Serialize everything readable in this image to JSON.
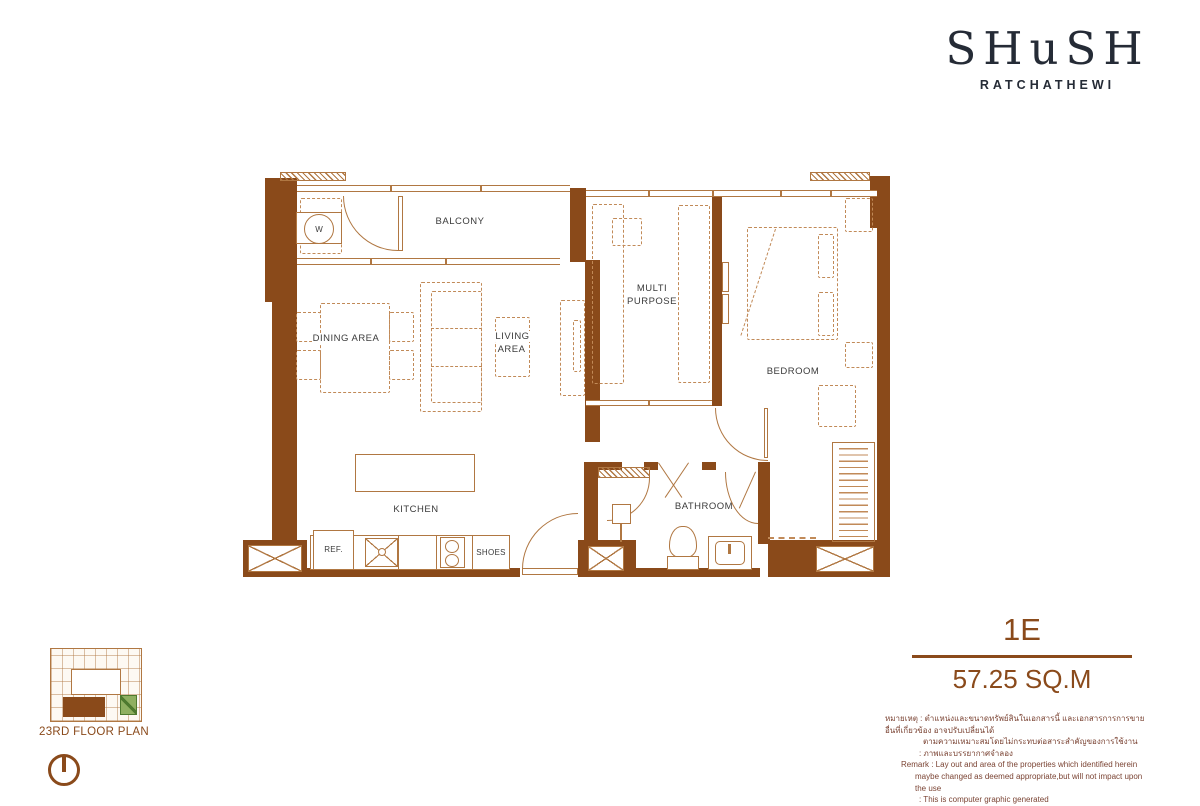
{
  "brand": {
    "name": "SHuSH",
    "location": "RATCHATHEWI"
  },
  "unit": {
    "code": "1E",
    "area": "57.25 SQ.M"
  },
  "key_plan": {
    "caption": "23RD FLOOR PLAN"
  },
  "plan": {
    "labels": {
      "balcony": "BALCONY",
      "dining": "DINING AREA",
      "living": "LIVING AREA",
      "kitchen": "KITCHEN",
      "multi_purpose": "MULTI PURPOSE",
      "bedroom": "BEDROOM",
      "bathroom": "BATHROOM",
      "washer": "W",
      "ref": "REF.",
      "shoes": "SHOES"
    }
  },
  "remark": {
    "lines": [
      "หมายเหตุ : ตำแหน่งและขนาดทรัพย์สินในเอกสารนี้ และเอกสารการการขายอื่นที่เกี่ยวข้อง อาจปรับเปลี่ยนได้",
      "ตามความเหมาะสมโดยไม่กระทบต่อสาระสำคัญของการใช้งาน",
      ": ภาพและบรรยากาศจำลอง",
      "Remark : Lay out and area of the properties which identified herein",
      "maybe changed as deemed appropriate,but will not impact upon the use",
      ": This is computer graphic generated"
    ]
  },
  "colors": {
    "wall_brown": "#8a4a1a",
    "fixture_tan": "#b07742",
    "logo_ink": "#252b36",
    "accent_brown": "#8a4a1b",
    "highlight_green": "#8fb061"
  }
}
